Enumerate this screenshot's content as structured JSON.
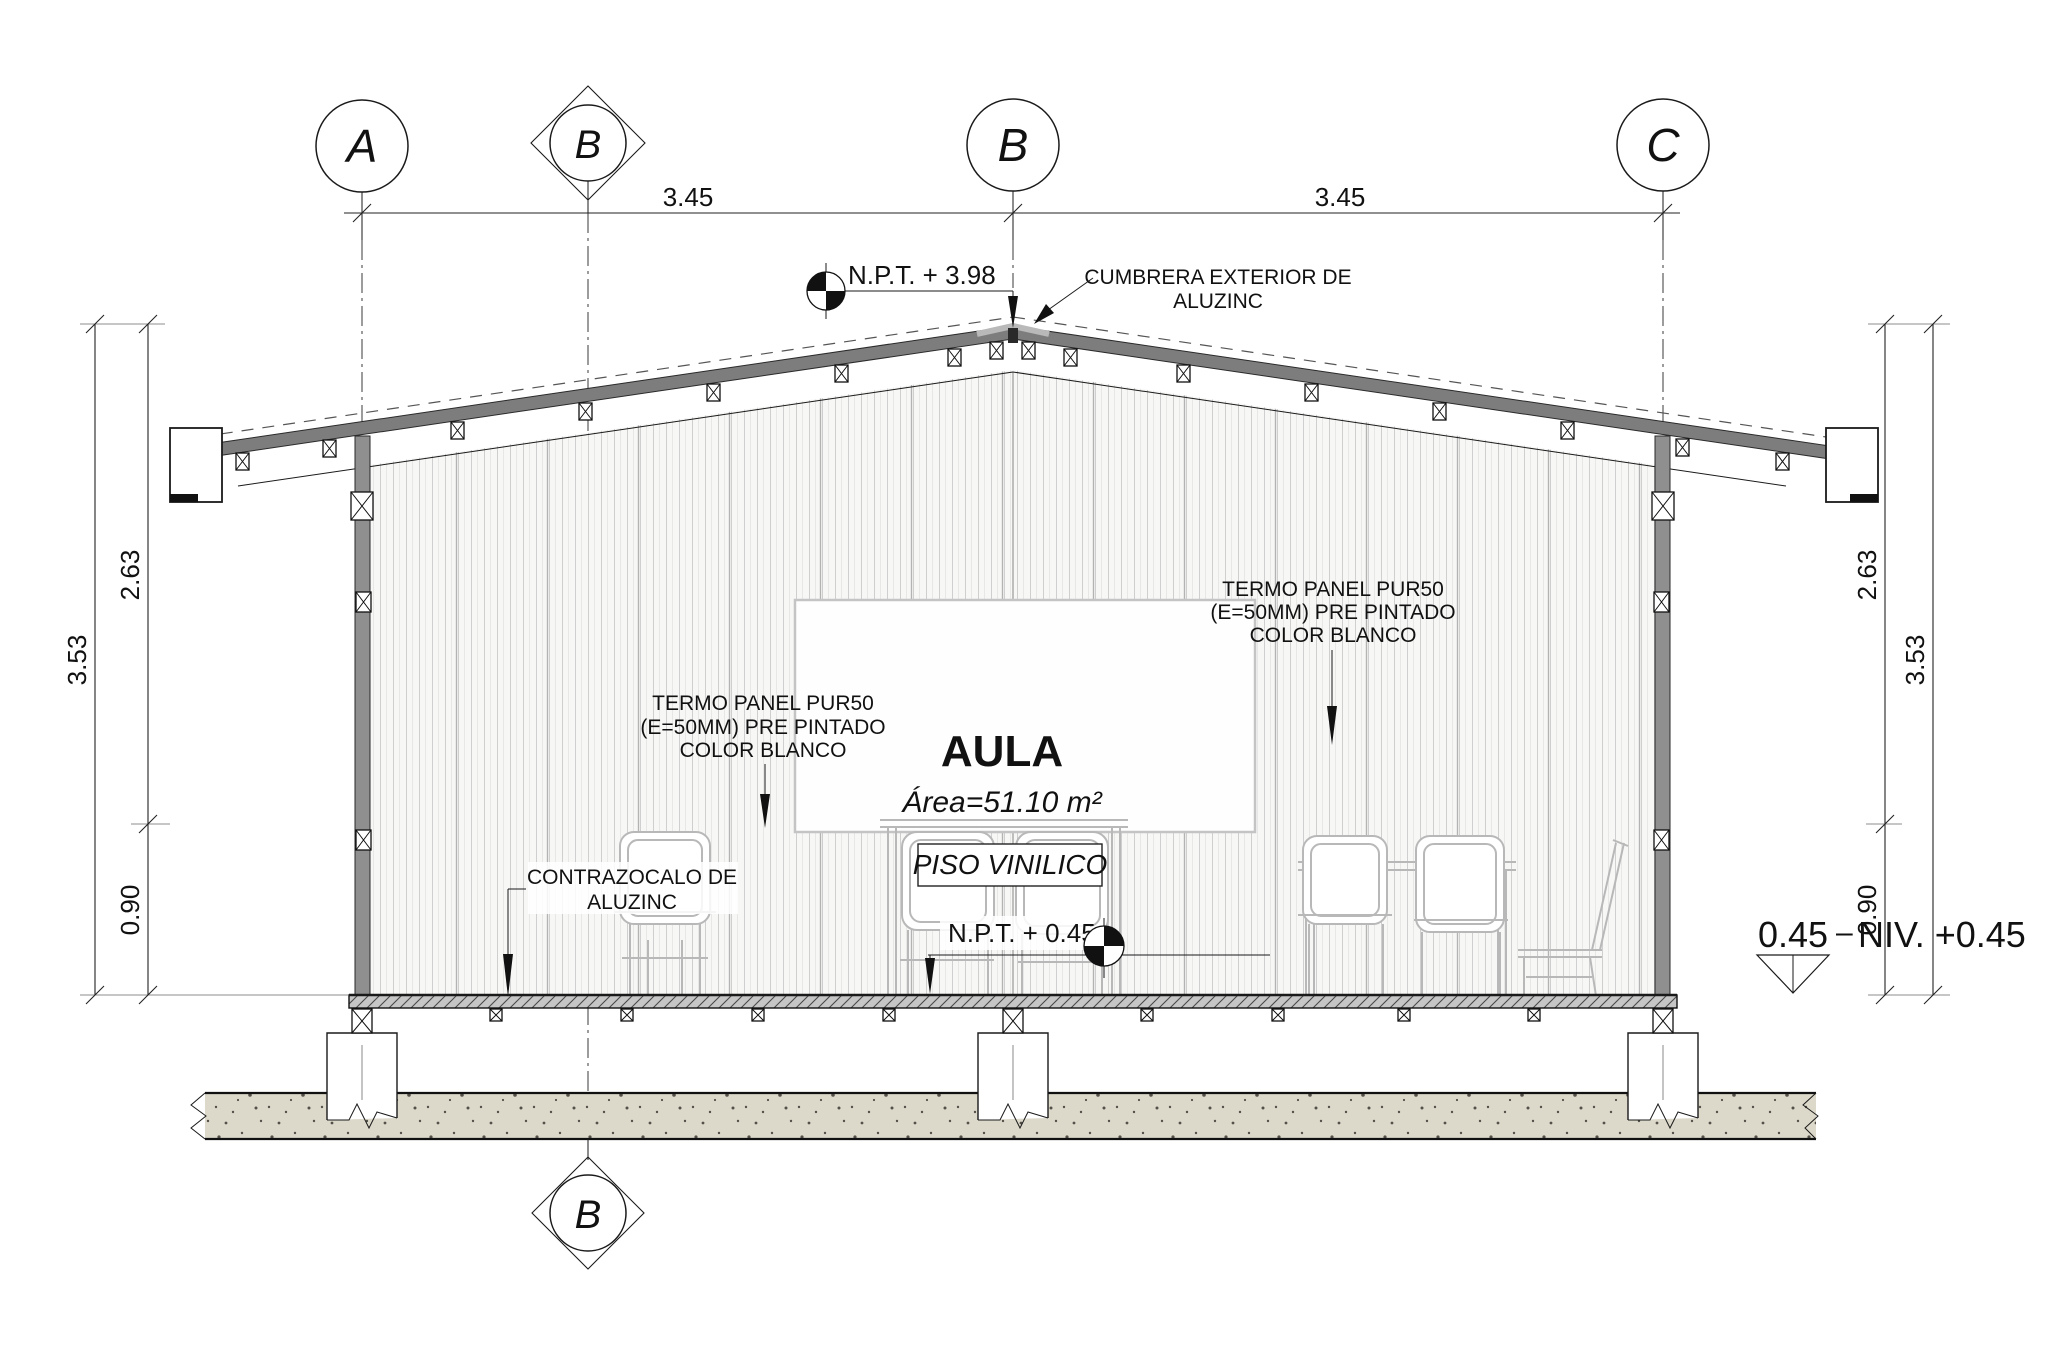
{
  "grid": {
    "a": "A",
    "b_section": "B",
    "b": "B",
    "c": "C",
    "b_section_bottom": "B"
  },
  "dimensions": {
    "span_ab": "3.45",
    "span_bc": "3.45",
    "left_total": "3.53",
    "left_upper": "2.63",
    "left_lower": "0.90",
    "right_upper": "2.63",
    "right_lower": "0.90",
    "right_total": "3.53"
  },
  "levels": {
    "ridge": "N.P.T. + 3.98",
    "floor": "N.P.T. + 0.45",
    "datum_value": "0.45",
    "datum_dash": "–",
    "datum_label": "NIV. +0.45"
  },
  "annotations": {
    "cumbrera": [
      "CUMBRERA EXTERIOR DE",
      "ALUZINC"
    ],
    "termo_left": [
      "TERMO PANEL PUR50",
      "(E=50MM) PRE PINTADO",
      "COLOR BLANCO"
    ],
    "termo_right": [
      "TERMO PANEL PUR50",
      "(E=50MM) PRE PINTADO",
      "COLOR BLANCO"
    ],
    "contrazocalo": [
      "CONTRAZOCALO DE",
      "ALUZINC"
    ],
    "piso": "PISO VINILICO"
  },
  "room": {
    "name": "AULA",
    "area": "Área=51.10 m²"
  },
  "colors": {
    "roof_band": "#7d7d7d",
    "ridge_cap": "#b9b9b9",
    "wall_column": "#8f8f8f",
    "corrugation_line": "#cfcfcf",
    "corrugation_dark": "#b3b3b3",
    "floor_hatch_bg": "#c6c6c6",
    "ground_fill": "#dcd9ca",
    "ground_dot": "#54514a",
    "furniture_line": "#b8b8b8",
    "whiteboard_border": "#c4c4c4"
  }
}
